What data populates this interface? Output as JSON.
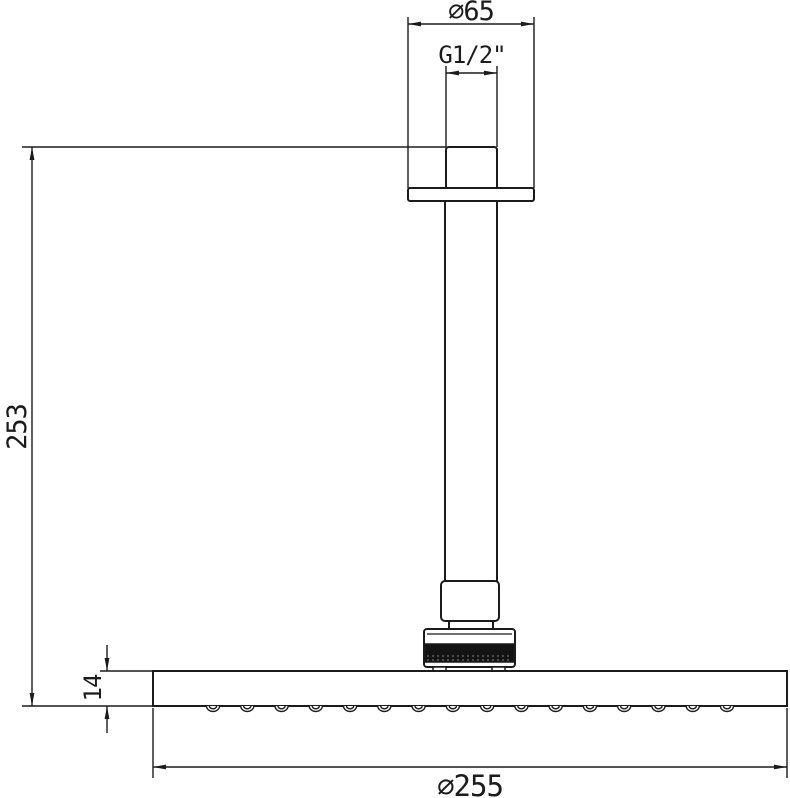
{
  "drawing": {
    "background_color": "#ffffff",
    "line_color": "#1b1b1b",
    "knurl_color": "#131313",
    "labels": {
      "flange_diameter": "∅65",
      "thread_size": "G1/2\"",
      "arm_length": "253",
      "head_thickness": "14",
      "head_diameter": "∅255"
    },
    "nozzles": {
      "count": 16
    }
  }
}
